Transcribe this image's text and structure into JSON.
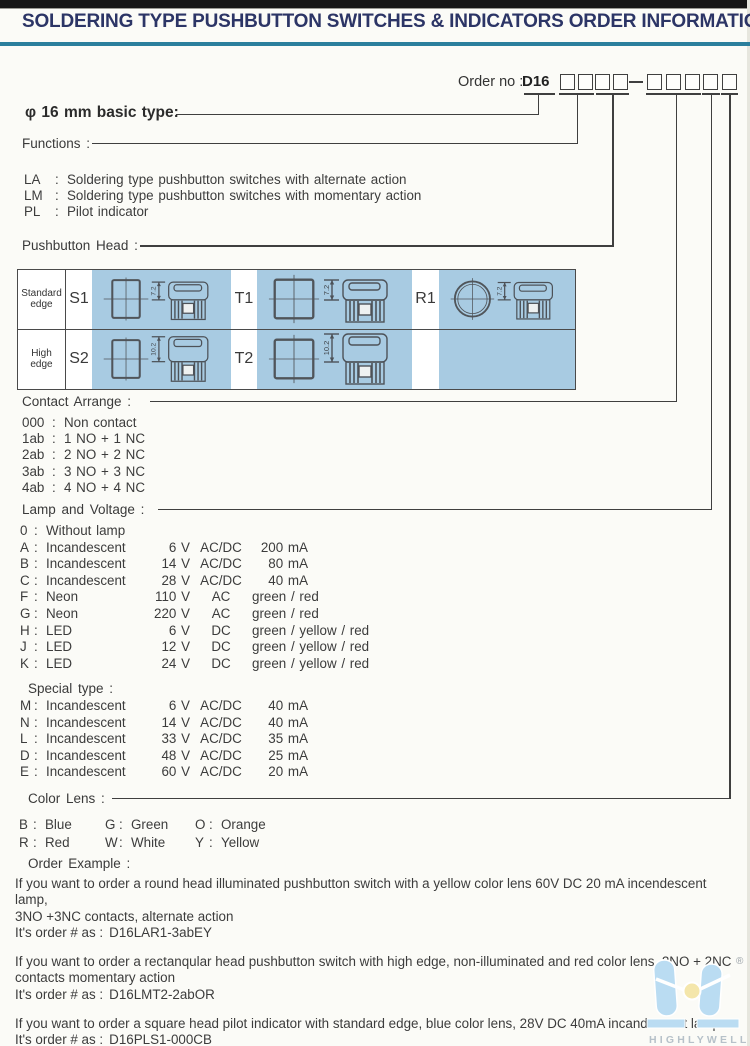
{
  "header": {
    "title": "SOLDERING TYPE PUSHBUTTON SWITCHES & INDICATORS ORDER INFORMATION"
  },
  "punct": {
    "colon": ":"
  },
  "order": {
    "label": "Order no :",
    "prefix": "D16",
    "group1_boxes": 4,
    "group2_boxes": 5
  },
  "basic_type": {
    "label": "φ 16 mm basic type:"
  },
  "functions": {
    "label": "Functions :",
    "items": [
      {
        "code": "LA",
        "desc": "Soldering type pushbutton switches with alternate action"
      },
      {
        "code": "LM",
        "desc": "Soldering type pushbutton switches with momentary action"
      },
      {
        "code": "PL",
        "desc": "Pilot indicator"
      }
    ]
  },
  "pushbutton_head": {
    "label": "Pushbutton Head :",
    "rows": [
      {
        "edge": "Standard edge",
        "dim": "7.2",
        "codes": [
          "S1",
          "T1",
          "R1"
        ]
      },
      {
        "edge": "High edge",
        "dim": "10.2",
        "codes": [
          "S2",
          "T2"
        ]
      }
    ]
  },
  "contact_arrange": {
    "label": "Contact Arrange :",
    "items": [
      {
        "code": "000",
        "desc": "Non contact"
      },
      {
        "code": "1ab",
        "desc": "1 NO + 1 NC"
      },
      {
        "code": "2ab",
        "desc": "2 NO + 2 NC"
      },
      {
        "code": "3ab",
        "desc": "3 NO + 3 NC"
      },
      {
        "code": "4ab",
        "desc": "4 NO + 4 NC"
      }
    ]
  },
  "lamp_voltage": {
    "label": "Lamp and Voltage :",
    "items": [
      {
        "code": "0",
        "name": "Without lamp",
        "voltage": "",
        "system": "",
        "current": "",
        "colors": ""
      },
      {
        "code": "A",
        "name": "Incandescent",
        "voltage": "6 V",
        "system": "AC/DC",
        "current": "200 mA",
        "colors": ""
      },
      {
        "code": "B",
        "name": "Incandescent",
        "voltage": "14 V",
        "system": "AC/DC",
        "current": "80 mA",
        "colors": ""
      },
      {
        "code": "C",
        "name": "Incandescent",
        "voltage": "28 V",
        "system": "AC/DC",
        "current": "40 mA",
        "colors": ""
      },
      {
        "code": "F",
        "name": "Neon",
        "voltage": "110 V",
        "system": "AC",
        "current": "",
        "colors": "green / red"
      },
      {
        "code": "G",
        "name": "Neon",
        "voltage": "220 V",
        "system": "AC",
        "current": "",
        "colors": "green / red"
      },
      {
        "code": "H",
        "name": "LED",
        "voltage": "6 V",
        "system": "DC",
        "current": "",
        "colors": "green / yellow / red"
      },
      {
        "code": "J",
        "name": "LED",
        "voltage": "12 V",
        "system": "DC",
        "current": "",
        "colors": "green / yellow / red"
      },
      {
        "code": "K",
        "name": "LED",
        "voltage": "24 V",
        "system": "DC",
        "current": "",
        "colors": "green / yellow / red"
      }
    ]
  },
  "special_type": {
    "label": "Special type :",
    "items": [
      {
        "code": "M",
        "name": "Incandescent",
        "voltage": "6 V",
        "system": "AC/DC",
        "current": "40 mA",
        "colors": ""
      },
      {
        "code": "N",
        "name": "Incandescent",
        "voltage": "14 V",
        "system": "AC/DC",
        "current": "40 mA",
        "colors": ""
      },
      {
        "code": "L",
        "name": "Incandescent",
        "voltage": "33 V",
        "system": "AC/DC",
        "current": "35 mA",
        "colors": ""
      },
      {
        "code": "D",
        "name": "Incandescent",
        "voltage": "48 V",
        "system": "AC/DC",
        "current": "25 mA",
        "colors": ""
      },
      {
        "code": "E",
        "name": "Incandescent",
        "voltage": "60 V",
        "system": "AC/DC",
        "current": "20 mA",
        "colors": ""
      }
    ]
  },
  "color_lens": {
    "label": "Color Lens :",
    "items": [
      {
        "code": "B",
        "name": "Blue"
      },
      {
        "code": "G",
        "name": "Green"
      },
      {
        "code": "O",
        "name": "Orange"
      },
      {
        "code": "R",
        "name": "Red"
      },
      {
        "code": "W",
        "name": "White"
      },
      {
        "code": "Y",
        "name": "Yellow"
      }
    ]
  },
  "order_example": {
    "label": "Order Example :",
    "examples": [
      {
        "text": "If you want to order a round head illuminated pushbutton switch with a yellow color lens 60V DC 20 mA incendescent lamp,\n3NO +3NC contacts, alternate action",
        "order_label": "It's order # as :",
        "order_no": "D16LAR1-3abEY"
      },
      {
        "text": "If you want to order a rectanqular head pushbutton switch with high edge, non-illuminated and red color lens, 2NO + 2NC\ncontacts momentary action",
        "order_label": "It's order # as :",
        "order_no": "D16LMT2-2abOR"
      },
      {
        "text": "If you want to order a square head pilot indicator with standard edge, blue color lens, 28V DC 40mA incandescent lamp.",
        "order_label": "It's order # as :",
        "order_no": "D16PLS1-000CB"
      }
    ]
  },
  "logo": {
    "text": "HIGHLYWELL",
    "registered": "®"
  },
  "colors": {
    "title_navy": "#2c3566",
    "header_rule": "#2b7f9d",
    "table_blue": "#a8cbe2",
    "logo_blue": "#badcf2",
    "logo_yellow": "#f4e6ab",
    "logo_text": "#b6c1c9"
  }
}
